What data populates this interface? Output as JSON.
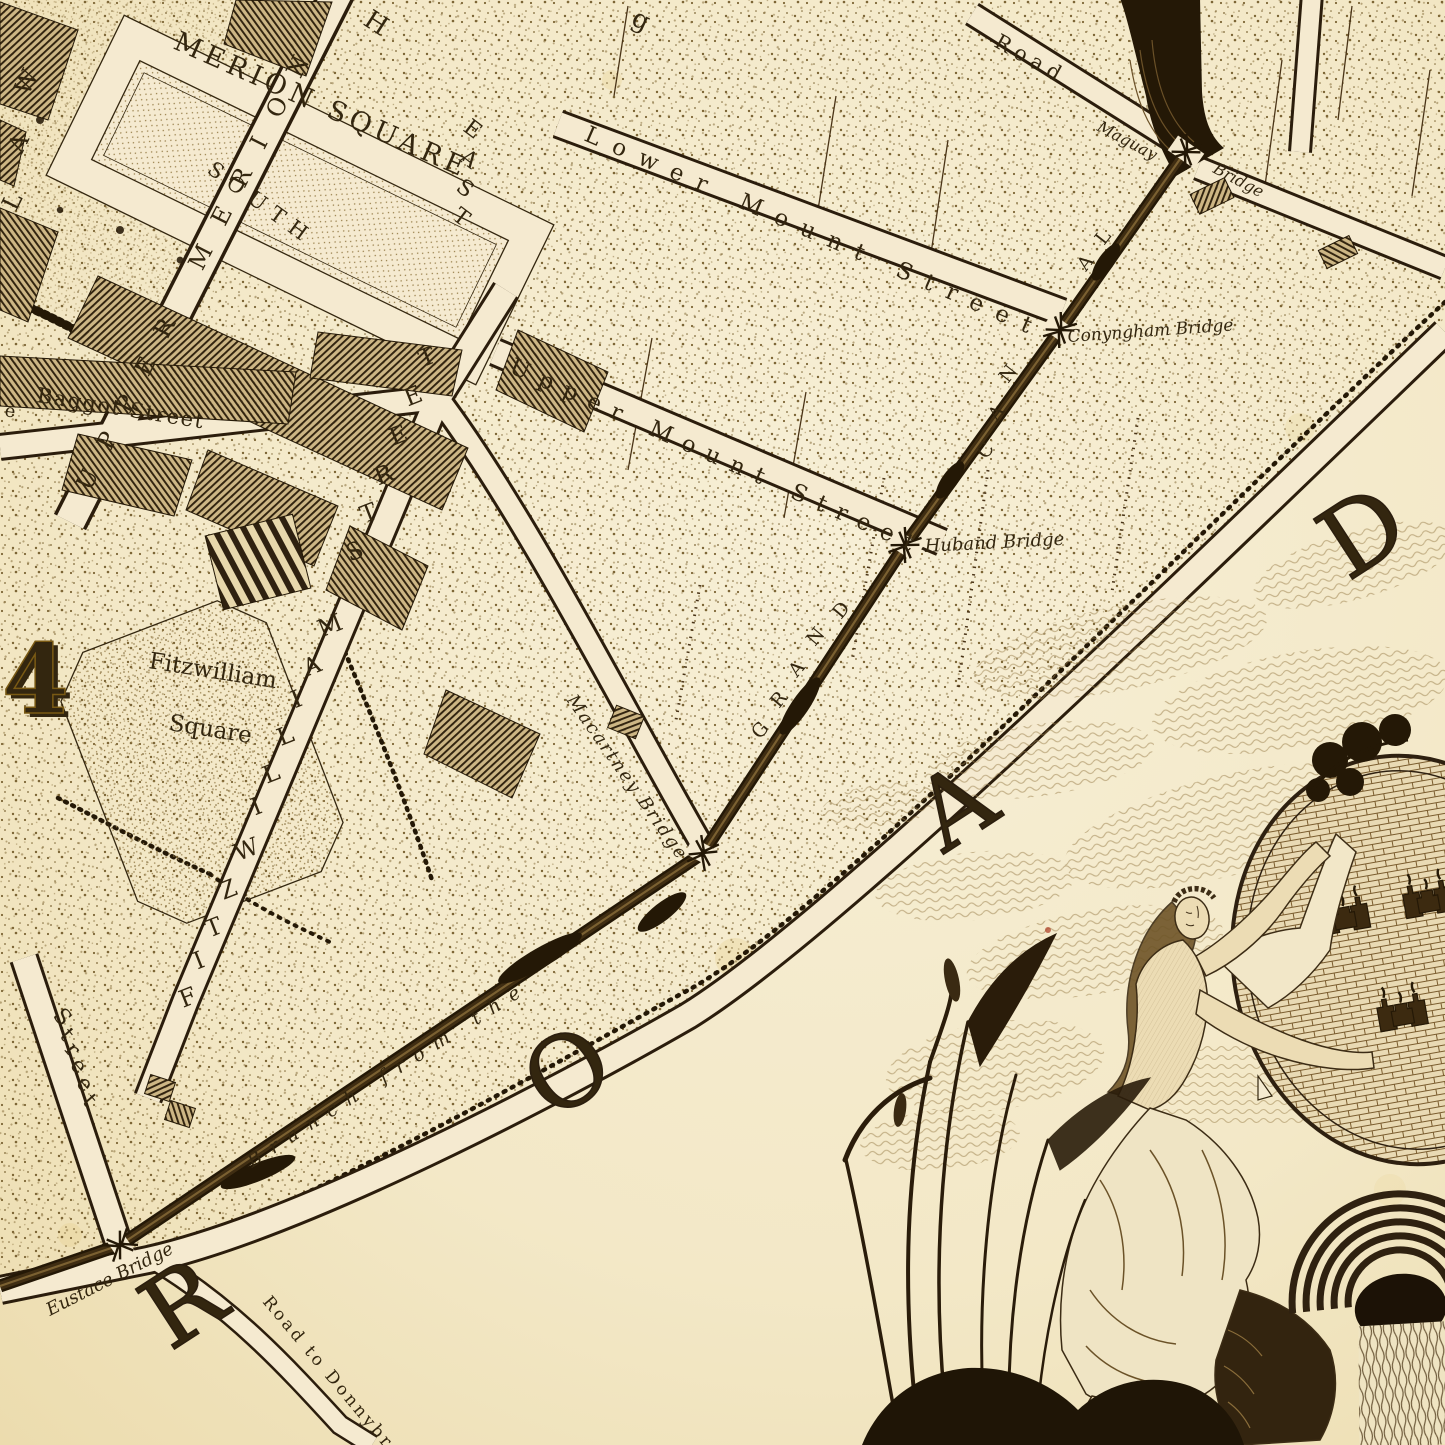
{
  "palette": {
    "paper": "#f3e8c7",
    "paper_light": "#f7efd8",
    "ink": "#33260f",
    "ink_dark": "#241806",
    "gold": "#c49a2e",
    "canal": "#241806",
    "stipple_dot": "#7c6535"
  },
  "map": {
    "plate_number": "4",
    "merrion_square": {
      "park_label": "MERION SQUARE",
      "south_side": "SOUTH",
      "east_side": "EAST",
      "north_fragment": "H"
    },
    "fitzwilliam_square": {
      "label_line1": "Fitzwilliam",
      "label_line2": "Square"
    },
    "streets": {
      "upper_merrion": "UPPER MERION",
      "lower_mount": "Lower Mount Street",
      "upper_mount": "Upper Mount Street",
      "baggot": "Baggot Street",
      "fitzwilliam_street": "FITZWILLIAM STREET",
      "road_top": "Road",
      "left_edge_street": "Street",
      "road_to_donnybrook": "Road to Donnybrook",
      "lawn_fragment": "LAW",
      "edge_fragment_e": "e",
      "edge_fragment_g": "g"
    },
    "canal": {
      "branch_label": "Branch from the",
      "grand_letters": [
        "G",
        "R",
        "A",
        "N",
        "D"
      ],
      "canal_letters_lower": [
        "C",
        "A",
        "N"
      ],
      "canal_letters_upper": [
        "A",
        "L"
      ]
    },
    "bridges": {
      "maguay_word1": "Maguay",
      "maguay_word2": "Bridge",
      "conyngham": "Conyngham Bridge",
      "huband": "Huband Bridge",
      "macartney": "Macartney Bridge",
      "eustace": "Eustace Bridge"
    },
    "road_letters": [
      "R",
      "O",
      "A",
      "D"
    ]
  }
}
